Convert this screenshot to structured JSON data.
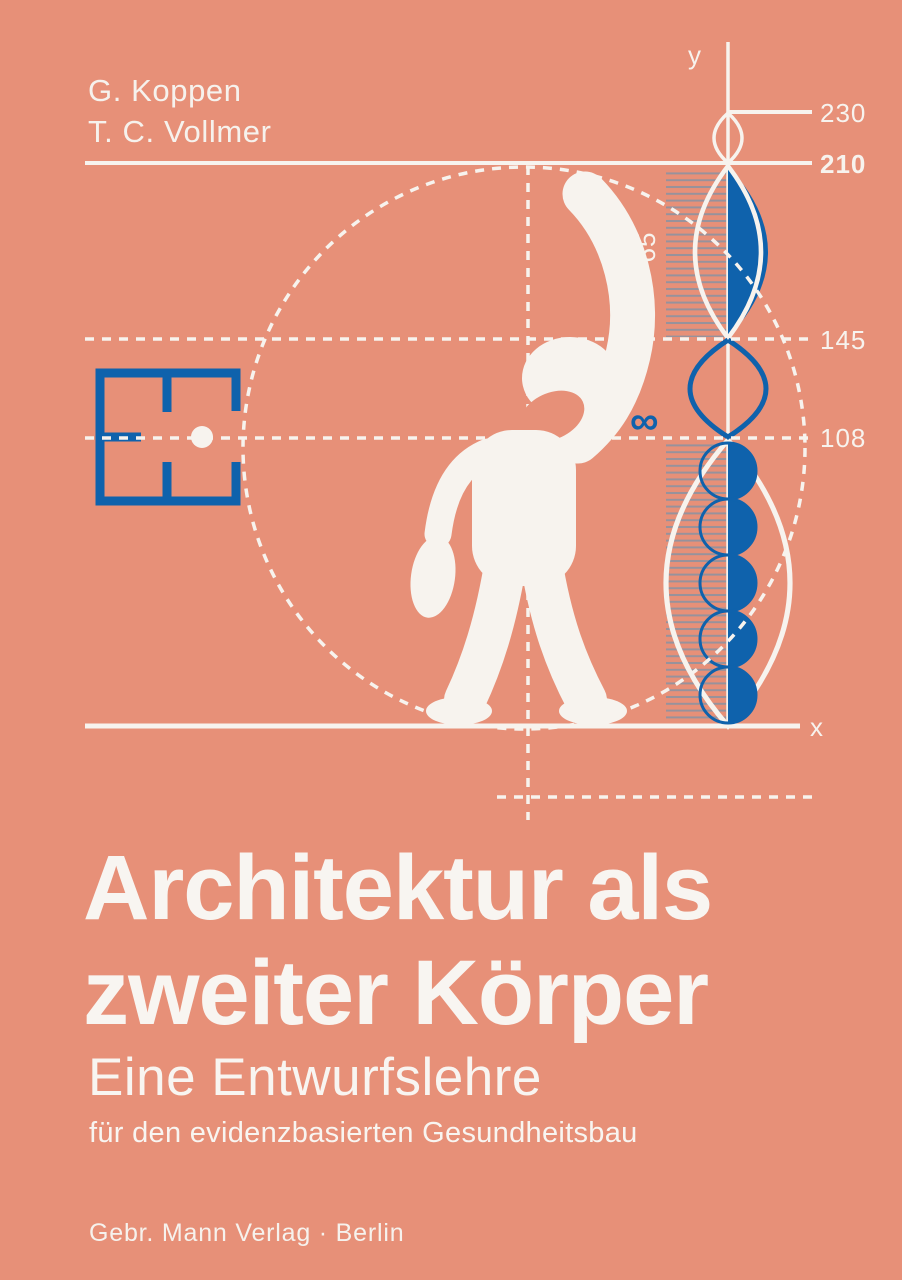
{
  "cover": {
    "authors": [
      "G. Koppen",
      "T. C. Vollmer"
    ],
    "title_line1": "Architektur als",
    "title_line2": "zweiter Körper",
    "subtitle": "Eine Entwurfslehre",
    "subtitle2": "für den evidenzbasierten Gesundheitsbau",
    "publisher": "Gebr. Mann Verlag · Berlin"
  },
  "diagram": {
    "y_axis_label": "y",
    "x_axis_label": "x",
    "mark_230": "230",
    "mark_210": "210",
    "mark_145": "145",
    "mark_108": "108",
    "segment_65": "65",
    "infinity_symbol": "∞",
    "height_values": [
      230,
      210,
      145,
      108,
      65
    ]
  },
  "colors": {
    "background_salmon": "#E79078",
    "accent_blue": "#0F62AC",
    "foreground_white": "#F7F3EE",
    "hatch_gray": "#8E93A0"
  }
}
